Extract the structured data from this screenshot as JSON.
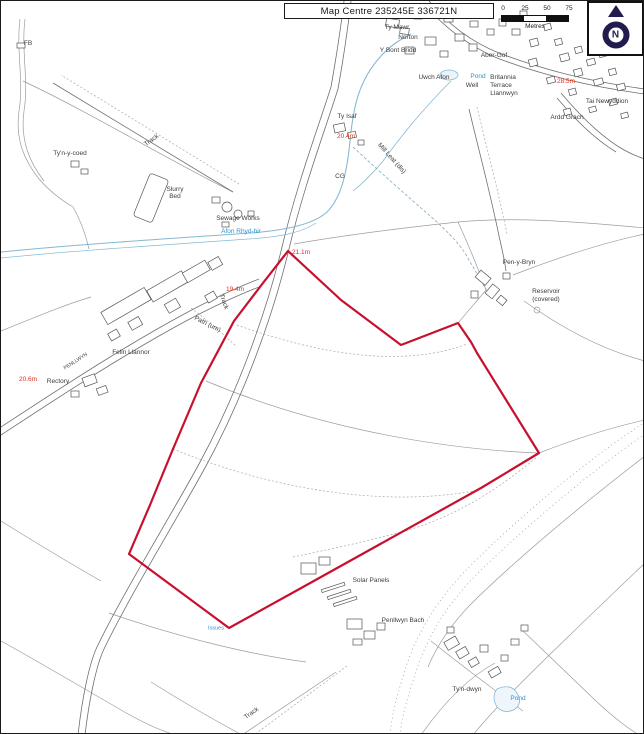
{
  "header": {
    "title": "Map Centre 235245E 336721N"
  },
  "north_arrow": {
    "label": "N",
    "color": "#221c4e"
  },
  "scale_bar": {
    "ticks": [
      "0",
      "25",
      "50",
      "75"
    ],
    "unit_label": "Metres"
  },
  "colors": {
    "name": "#3c3c3c",
    "water": "#2e93cf",
    "spot": "#e0301e",
    "boundary": "#c8102e"
  },
  "site_boundary": {
    "points": "287,250 340,299 400,344 457,322 470,341 476,352 538,452 480,487 302,586 228,627 128,553 149,504 172,448 200,382 233,320 262,282"
  },
  "labels": [
    {
      "text": "FB",
      "x": 27,
      "y": 43,
      "type": "name"
    },
    {
      "text": "Pentrefelin",
      "x": 411,
      "y": 9,
      "type": "name"
    },
    {
      "text": "Ty Mawr",
      "x": 396,
      "y": 27,
      "type": "name"
    },
    {
      "text": "Norton",
      "x": 407,
      "y": 37,
      "type": "name"
    },
    {
      "text": "Y Bont Bridd",
      "x": 397,
      "y": 50,
      "type": "name"
    },
    {
      "text": "Uwch Afon",
      "x": 433,
      "y": 77,
      "type": "name"
    },
    {
      "text": "Aber-Gof",
      "x": 493,
      "y": 55,
      "type": "name"
    },
    {
      "text": "Pond",
      "x": 477,
      "y": 76,
      "type": "water"
    },
    {
      "text": "Well",
      "x": 471,
      "y": 85,
      "type": "name"
    },
    {
      "text": "Britannia",
      "x": 502,
      "y": 77,
      "type": "name"
    },
    {
      "text": "Terrace",
      "x": 500,
      "y": 85,
      "type": "name"
    },
    {
      "text": "Llannwyn",
      "x": 503,
      "y": 93,
      "type": "name"
    },
    {
      "text": "Tai Newyddion",
      "x": 606,
      "y": 101,
      "type": "name"
    },
    {
      "text": "Ardd Grach",
      "x": 566,
      "y": 117,
      "type": "name"
    },
    {
      "text": "28.5m",
      "x": 565,
      "y": 81,
      "type": "spot"
    },
    {
      "text": "Ty Isaf",
      "x": 346,
      "y": 116,
      "type": "name"
    },
    {
      "text": "20.4m",
      "x": 345,
      "y": 136,
      "type": "spot"
    },
    {
      "text": "Track",
      "x": 151,
      "y": 140,
      "type": "name",
      "rot": -35
    },
    {
      "text": "Slurry",
      "x": 174,
      "y": 189,
      "type": "name"
    },
    {
      "text": "Bed",
      "x": 174,
      "y": 196,
      "type": "name"
    },
    {
      "text": "Sewage Works",
      "x": 237,
      "y": 218,
      "type": "name"
    },
    {
      "text": "Afon Rhyd-hir",
      "x": 240,
      "y": 231,
      "type": "water"
    },
    {
      "text": "CG",
      "x": 339,
      "y": 176,
      "type": "name"
    },
    {
      "text": "Mill Leat (dis)",
      "x": 390,
      "y": 158,
      "type": "name",
      "rot": 48
    },
    {
      "text": "Ty'n-y-coed",
      "x": 69,
      "y": 153,
      "type": "name"
    },
    {
      "text": "Pen-y-Bryn",
      "x": 518,
      "y": 262,
      "type": "name"
    },
    {
      "text": "Reservoir",
      "x": 545,
      "y": 291,
      "type": "name"
    },
    {
      "text": "(covered)",
      "x": 545,
      "y": 299,
      "type": "name"
    },
    {
      "text": "21.1m",
      "x": 300,
      "y": 252,
      "type": "spot"
    },
    {
      "text": "19.4m",
      "x": 234,
      "y": 289,
      "type": "spot"
    },
    {
      "text": "Track",
      "x": 222,
      "y": 301,
      "type": "name",
      "rot": 70
    },
    {
      "text": "Path (um)",
      "x": 206,
      "y": 324,
      "type": "name",
      "rot": 27
    },
    {
      "text": "Felin Llannor",
      "x": 130,
      "y": 352,
      "type": "name"
    },
    {
      "text": "Rectory",
      "x": 57,
      "y": 381,
      "type": "name"
    },
    {
      "text": "20.6m",
      "x": 27,
      "y": 379,
      "type": "spot"
    },
    {
      "text": "PENLLWYN",
      "x": 75,
      "y": 361,
      "type": "name",
      "rot": -33,
      "size": 5
    },
    {
      "text": "Solar Panels",
      "x": 370,
      "y": 580,
      "type": "name"
    },
    {
      "text": "Penllwyn Bach",
      "x": 402,
      "y": 620,
      "type": "name"
    },
    {
      "text": "Issues",
      "x": 215,
      "y": 628,
      "type": "water",
      "size": 5.5
    },
    {
      "text": "Ty'n-dwyn",
      "x": 466,
      "y": 689,
      "type": "name"
    },
    {
      "text": "Pond",
      "x": 517,
      "y": 698,
      "type": "water"
    },
    {
      "text": "Track",
      "x": 251,
      "y": 713,
      "type": "name",
      "rot": -35
    }
  ]
}
